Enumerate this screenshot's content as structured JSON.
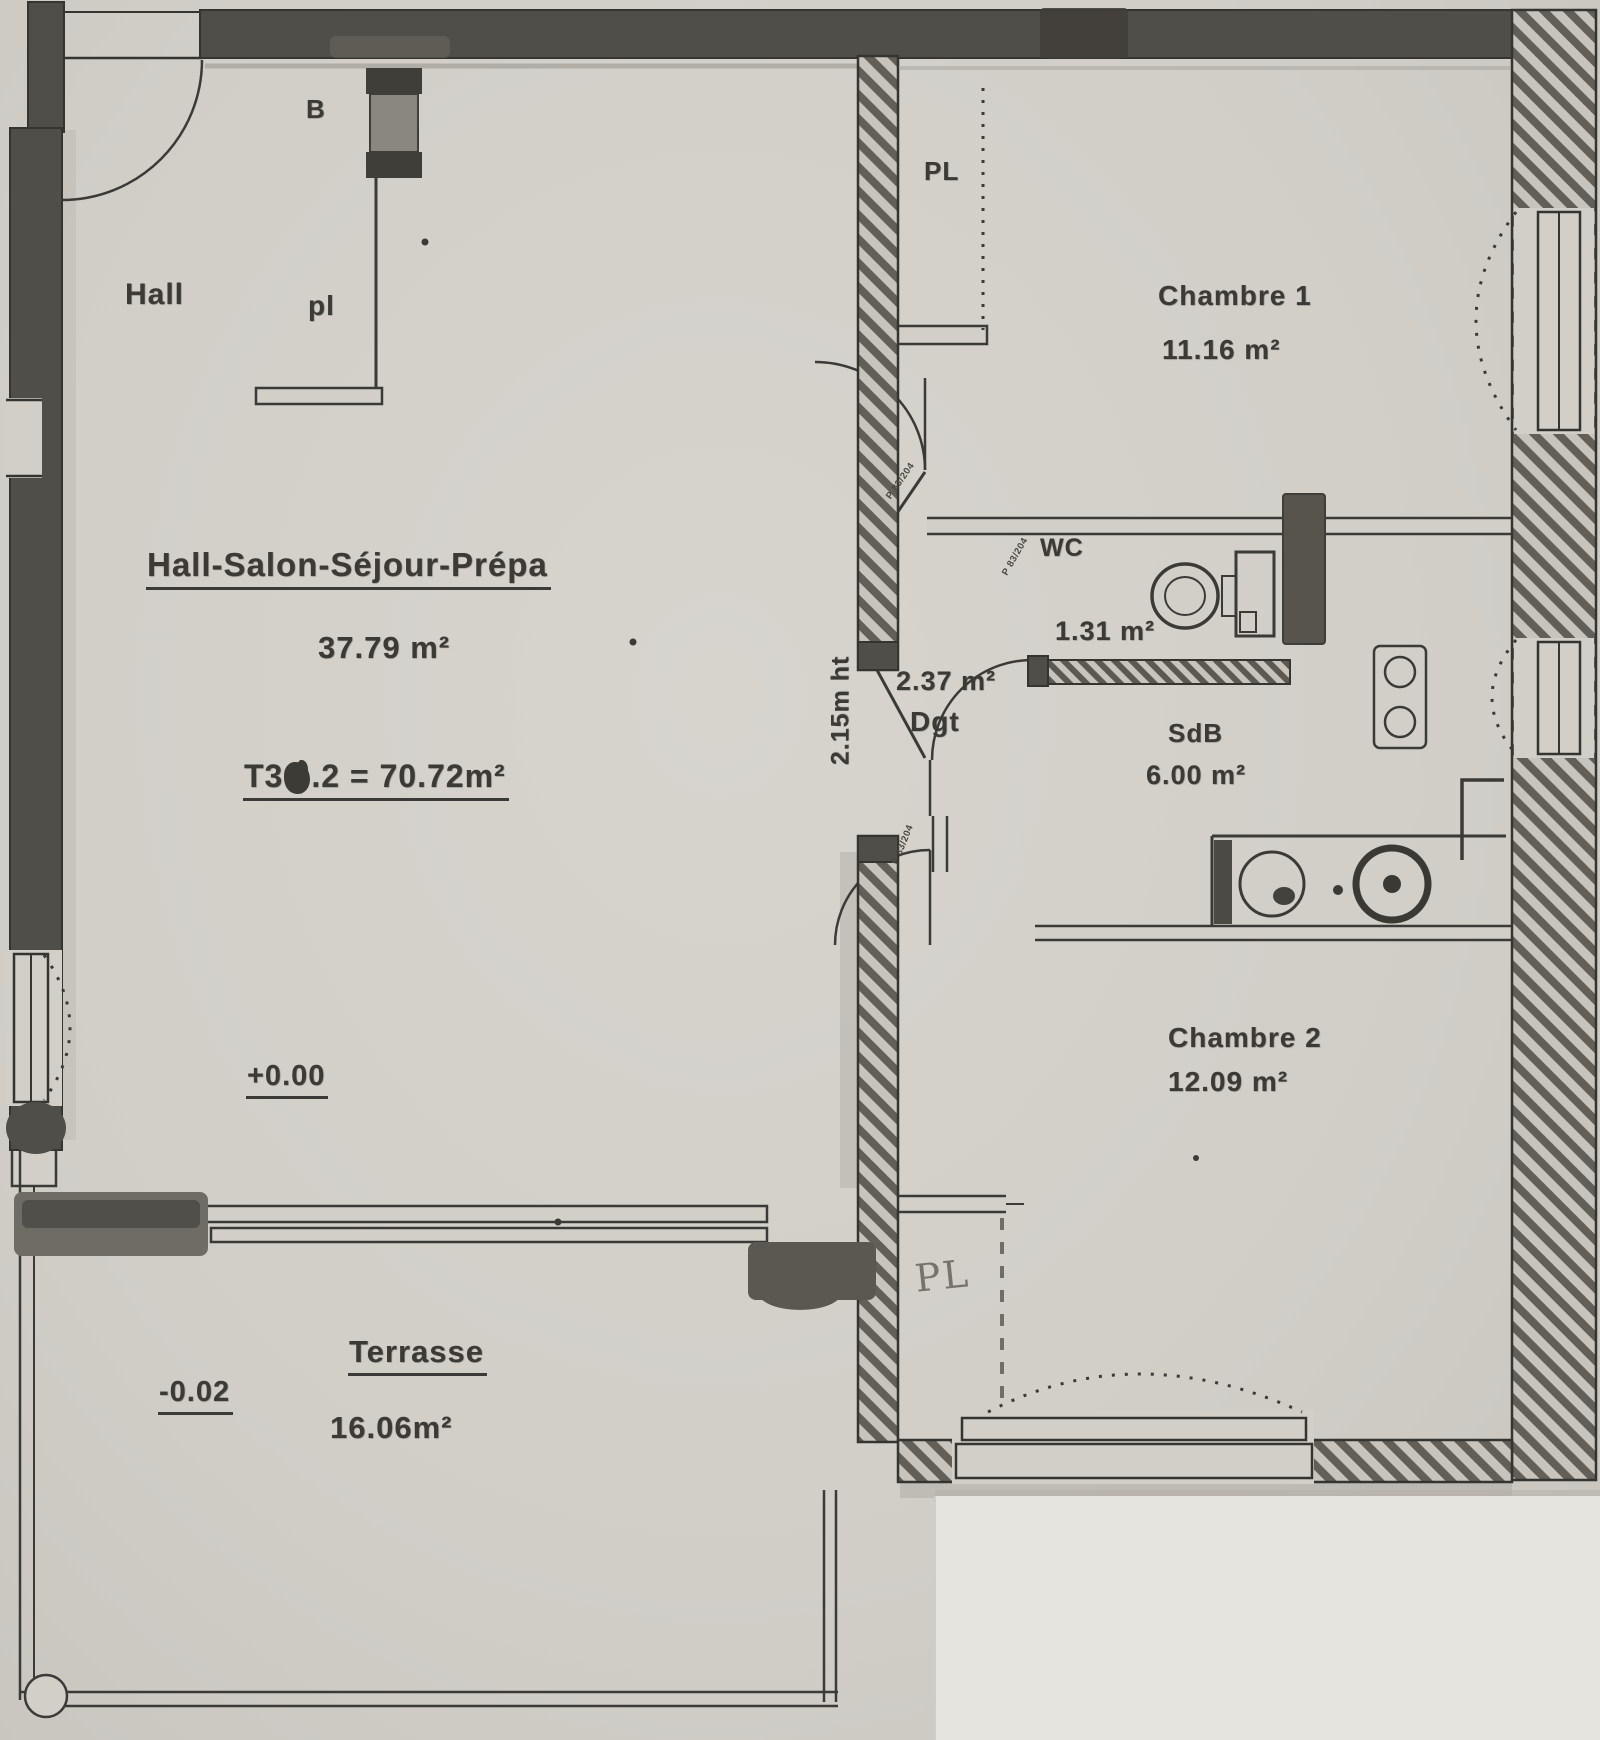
{
  "rooms": {
    "living": {
      "title": "Hall-Salon-Séjour-Prépa",
      "area": "37.79 m²",
      "level": "+0.00"
    },
    "hall": {
      "label": "Hall"
    },
    "chambre1": {
      "label": "Chambre 1",
      "area": "11.16 m²"
    },
    "chambre2": {
      "label": "Chambre 2",
      "area": "12.09 m²"
    },
    "wc": {
      "label": "WC",
      "area": "1.31 m²"
    },
    "sdb": {
      "label": "SdB",
      "area": "6.00 m²"
    },
    "dgt": {
      "label": "Dgt",
      "area": "2.37 m²",
      "height_note": "2.15m ht"
    },
    "terrasse": {
      "label": "Terrasse",
      "area": "16.06m²",
      "level": "-0.02"
    }
  },
  "title_block": {
    "prefix": "T3",
    "suffix": ".2 = 70.72m²"
  },
  "closets": {
    "b_label": "B",
    "hall_pl": "pl",
    "top_pl": "PL",
    "chambre2_pl": "PL"
  },
  "doors": {
    "tag": "P 83/204"
  },
  "colors": {
    "paper": "#d2cfc9",
    "ink": "#3b3a36",
    "wall": "#504e48",
    "pencil": "#75736c"
  }
}
